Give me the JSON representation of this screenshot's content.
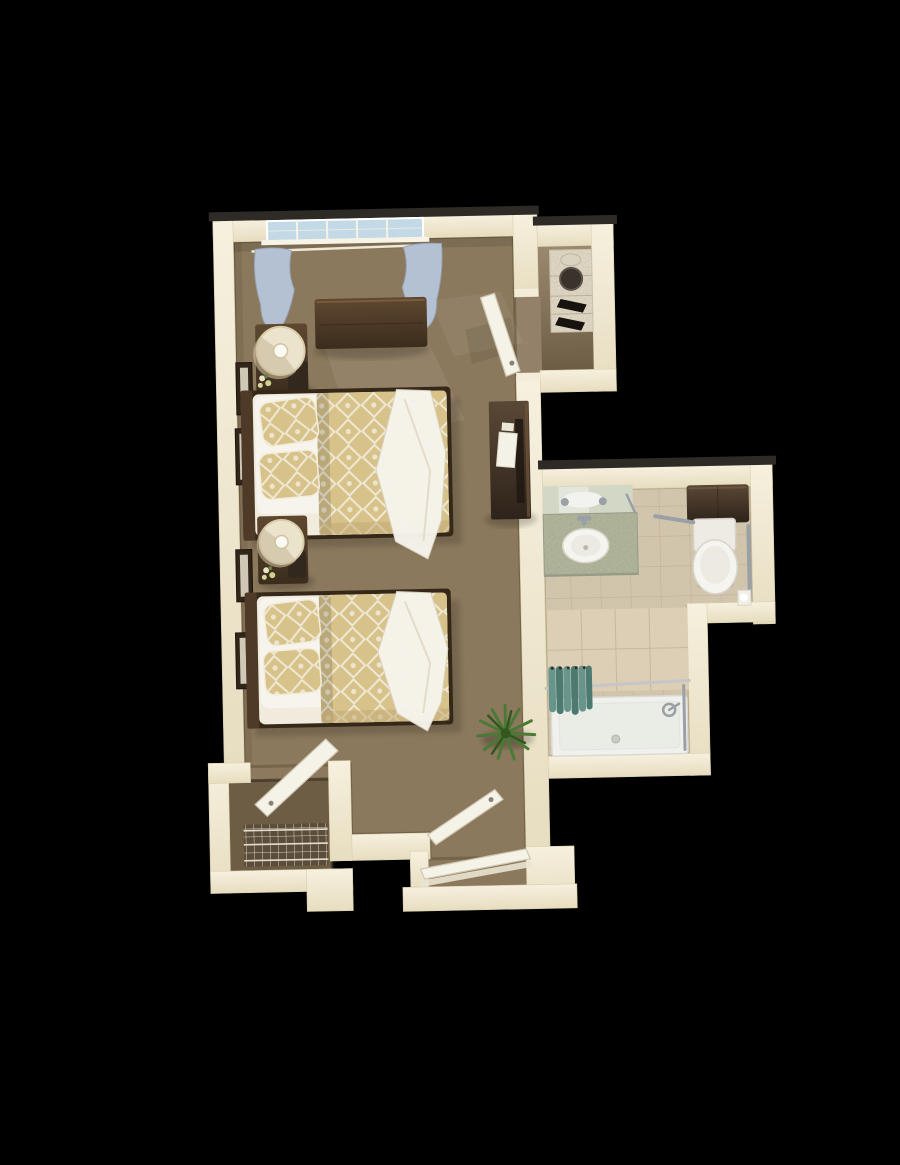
{
  "scene": {
    "type": "3d-floor-plan-render",
    "description": "Top-down 3D rendering of a studio companion suite floor plan with a shared bedroom containing two beds, a bathroom, a linen closet, a walk-in closet and an entry alcove, on a black background",
    "view": "top-down oblique",
    "tilt_degrees": -1.2
  },
  "colors": {
    "background": "#000000",
    "wall_cap": "#2e2b27",
    "wall": "#f2ecd8",
    "carpet": "#8d7a5e",
    "carpet_shadow": "#6f5f47",
    "tile": "#d4c7ae",
    "grout": "#c1b298",
    "shower_tile": "#dccfb6",
    "closet_floor": "#6e5d45",
    "linen_closet_floor": "#93816a",
    "wood": "#4e3a27",
    "wood_light": "#7a5c3c",
    "wood_dark": "#352818",
    "linen": "#f0ebdc",
    "white": "#f6f4ec",
    "gold": "#d7c28a",
    "gold_deep": "#bfa66f",
    "pattern_line": "#efe8d3",
    "glass": "#c3d9e5",
    "curtain": "#b4c1d2",
    "curtain_dark": "#8e9db1",
    "door": "#f5f2e8",
    "chrome": "#9aa0a6",
    "teal": "#67948b",
    "teal_dark": "#4c7a70",
    "granite": "#b4bba1",
    "porcelain": "#f6f4ee",
    "cabinet": "#4a3a2b",
    "plant": "#4c7a36",
    "plant_dark": "#33571f",
    "frame_wood": "#322618",
    "art_mat": "#cfc8b6"
  },
  "rooms": [
    {
      "name": "bedroom",
      "floor": "carpet",
      "furniture": [
        "window-with-curtains",
        "dresser",
        "nightstand-1",
        "table-lamp-1",
        "bed-1",
        "nightstand-2",
        "table-lamp-2",
        "bed-2",
        "desk-with-papers",
        "potted-plant",
        "wall-art-1",
        "wall-art-2",
        "wall-art-3",
        "wall-art-4"
      ]
    },
    {
      "name": "bathroom",
      "floor": "tile",
      "fixtures": [
        "vanity-mirror",
        "vanity-counter",
        "sink",
        "faucet",
        "toilet",
        "overhead-cabinet",
        "grab-bar-horizontal",
        "grab-bar-vertical",
        "toilet-paper-holder",
        "shower-pan",
        "shower-curtain",
        "shower-rod",
        "shower-valve"
      ]
    },
    {
      "name": "linen-closet",
      "floor": "wood-tan",
      "fixtures": [
        "shelving-unit",
        "basket",
        "stacked-linens"
      ]
    },
    {
      "name": "walk-in-closet",
      "floor": "carpet-dark",
      "fixtures": [
        "wire-shelving",
        "closet-door-open"
      ]
    },
    {
      "name": "entry",
      "floor": "carpet",
      "fixtures": [
        "entry-door-open",
        "threshold"
      ]
    }
  ],
  "doors": [
    {
      "name": "bedroom-to-linen-closet-door",
      "state": "open"
    },
    {
      "name": "walk-in-closet-door",
      "state": "open"
    },
    {
      "name": "entry-inner-door",
      "state": "open"
    },
    {
      "name": "entry-outer-door",
      "state": "open"
    }
  ],
  "counts": {
    "beds": 2,
    "pillows_per_bed": 2,
    "lamps": 2,
    "wall_art": 4,
    "sinks": 1,
    "toilets": 1,
    "showers": 1
  }
}
